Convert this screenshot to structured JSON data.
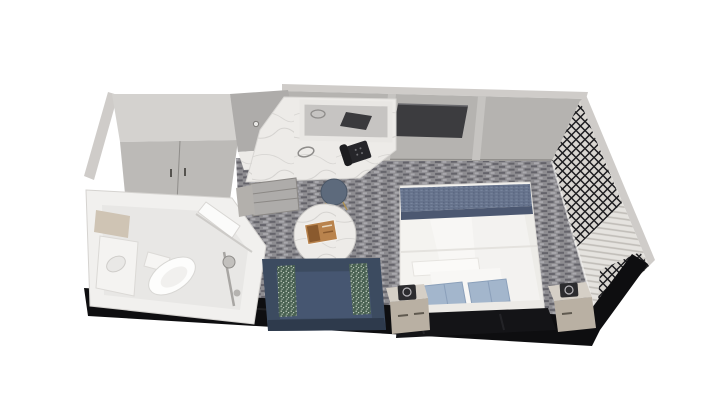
{
  "scene": {
    "kind": "3d-floor-plan-render",
    "subject": "cruise stateroom cutaway viewed from above",
    "areas": {
      "bathroom": [
        "toilet",
        "sink-vanity",
        "sink-mirror",
        "shower",
        "bathroom-door"
      ],
      "closet": [
        "wardrobe",
        "hook-rack"
      ],
      "vanity_desk": [
        "marble-counter",
        "mirror",
        "telephone",
        "cord-ring",
        "drawer-cabinet",
        "stool"
      ],
      "living_area": [
        "sofa",
        "accent-pillow-left",
        "accent-pillow-right",
        "coffee-table",
        "book"
      ],
      "sleeping_area": [
        "bed",
        "bed-runner",
        "bed-pillow-left",
        "bed-pillow-right",
        "white-pillow",
        "headboard",
        "nightstand-left",
        "nightstand-right",
        "table-lamp-left",
        "table-lamp-right"
      ],
      "walls": [
        "far-wall",
        "tv-screen",
        "left-wall",
        "lattice-screen-upper",
        "lattice-screen-lower",
        "louver-panel",
        "cutaway-near-wall"
      ]
    }
  },
  "palette": {
    "carpet_base": "#8e8d91",
    "carpet_dark": "#64636a",
    "carpet_light": "#a9a8ad",
    "wall": "#b5b3b0",
    "wall_top": "#cfccc9",
    "wall_trim": "#c6c4c1",
    "tv": "#3c3c3f",
    "lattice_bg": "#d8d5d0",
    "lattice_line": "#1d1d20",
    "louver_light": "#e5e3df",
    "louver_dark": "#c2bfba",
    "cutaway": "#0e0e10",
    "wardrobe_top": "#d4d2cf",
    "wardrobe_door": "#bcbab7",
    "alcove": "#aeacaa",
    "marble": "#edebe8",
    "marble_vein": "#cfcdcb",
    "bath_wall": "#f1f0ee",
    "bath_floor": "#e8e7e5",
    "fixture": "#c2c0bd",
    "bed_linen": "#f4f3f0",
    "runner": "#66738c",
    "runner_dark": "#4c5871",
    "pillow_blue": "#a3b6cc",
    "headboard": "#141417",
    "nightstand_top": "#d5cfc6",
    "nightstand_front": "#b9b0a3",
    "lamp": "#2c2c2f",
    "sofa": "#3c4b60",
    "sofa_seat": "#465671",
    "sofa_dark": "#2e3a4c",
    "accent": "#4a6253",
    "accent_speckle": "#cdd7cb",
    "table_leg": "#3b3b3e",
    "book": "#b9834d",
    "book_dark": "#8a5a2e",
    "stool": "#5d6a7c",
    "stool_gold": "#ab9054",
    "phone": "#26262a"
  }
}
